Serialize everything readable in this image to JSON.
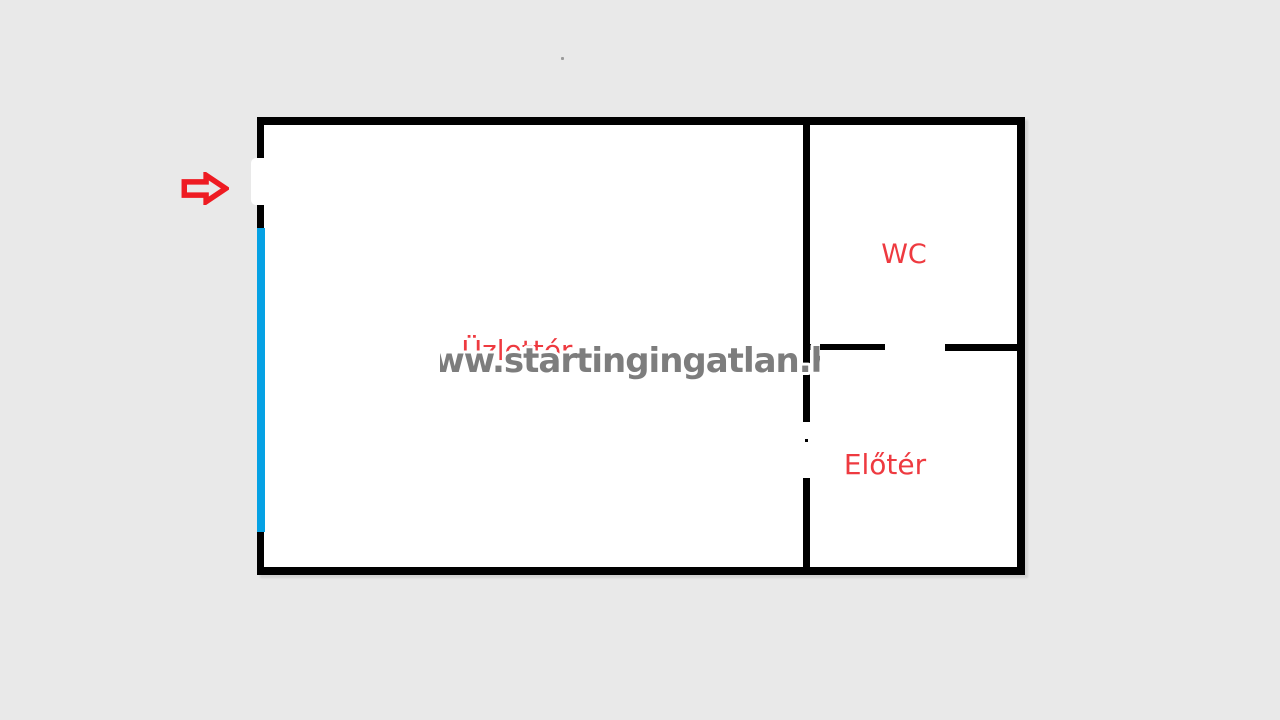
{
  "canvas": {
    "background_color": "#e9e9e9"
  },
  "floorplan": {
    "wall_color": "#000000",
    "room_fill": "#ffffff",
    "window_color": "#05a1e4",
    "label_color": "#ee3a40",
    "rooms": [
      {
        "id": "uzletter",
        "label": "Üzlettér"
      },
      {
        "id": "wc",
        "label": "WC"
      },
      {
        "id": "eloter",
        "label": "Előtér"
      }
    ],
    "entrance_arrow": {
      "color": "#ee1b22",
      "direction": "right"
    }
  },
  "watermark": {
    "text": "www.startingingatlan.hu",
    "fill_color": "#7d7d7d",
    "outline_color": "#ffffff"
  }
}
